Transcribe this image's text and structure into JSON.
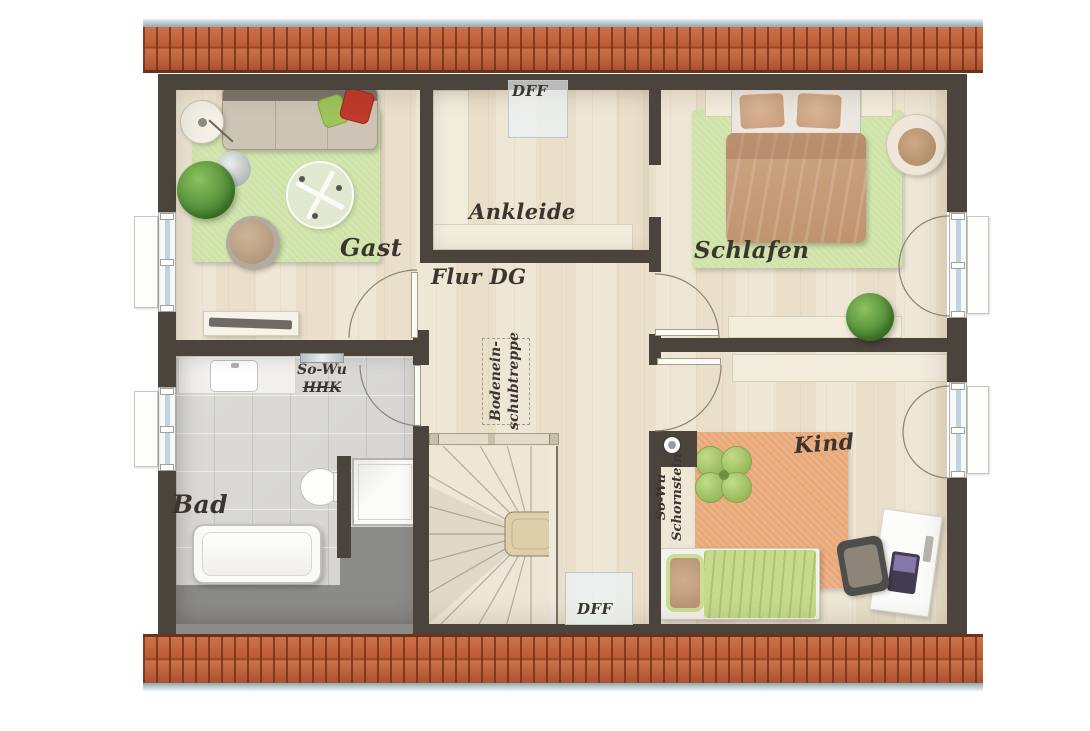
{
  "floor_plan": {
    "rooms": {
      "gast": "Gast",
      "ankleide": "Ankleide",
      "schlafen": "Schlafen",
      "flur": "Flur DG",
      "bad": "Bad",
      "kind": "Kind"
    },
    "annotations": {
      "dff_top": "DFF",
      "dff_bottom": "DFF",
      "sowu_line1": "So-Wu",
      "sowu_line2": "HHK",
      "chimney_line1": "So-Wu",
      "chimney_line2": "Schornstein",
      "loft_line1": "Bodenein-",
      "loft_line2": "schubtreppe"
    },
    "colors": {
      "wall": "#4b443c",
      "roof_tile": "#bc5c36",
      "roof_gutter": "#a6b8c0",
      "wood_floor": "#ede4d1",
      "bath_tile": "#d9d8d4",
      "low_height_zone": "#8b8b88",
      "rug_green": "#cfe3a9",
      "rug_orange": "#e9a878",
      "bed_blanket": "#c79e80",
      "pillow_red": "#c0392b",
      "pillow_green": "#9fc45c"
    }
  }
}
